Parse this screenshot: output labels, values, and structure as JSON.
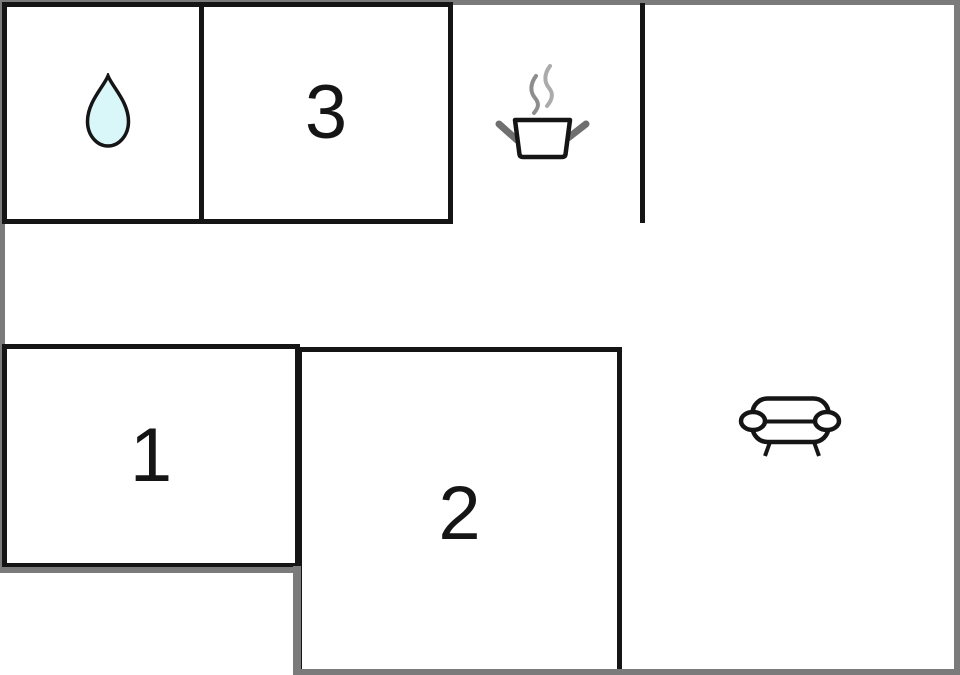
{
  "rooms": {
    "bathroom": {
      "icon": "water-drop-icon"
    },
    "bedroom3": {
      "label": "3"
    },
    "kitchen": {
      "icon": "cooking-pot-icon"
    },
    "bedroom1": {
      "label": "1"
    },
    "bedroom2": {
      "label": "2"
    },
    "living_room": {
      "icon": "sofa-icon"
    }
  },
  "colors": {
    "background": "#ffffff",
    "wall": "#151515",
    "outline": "#7b7b7b",
    "drop_fill": "#d9f6f8",
    "handle": "#6f6f6f",
    "steam_dark": "#8d8d8d",
    "steam_light": "#ababab"
  }
}
